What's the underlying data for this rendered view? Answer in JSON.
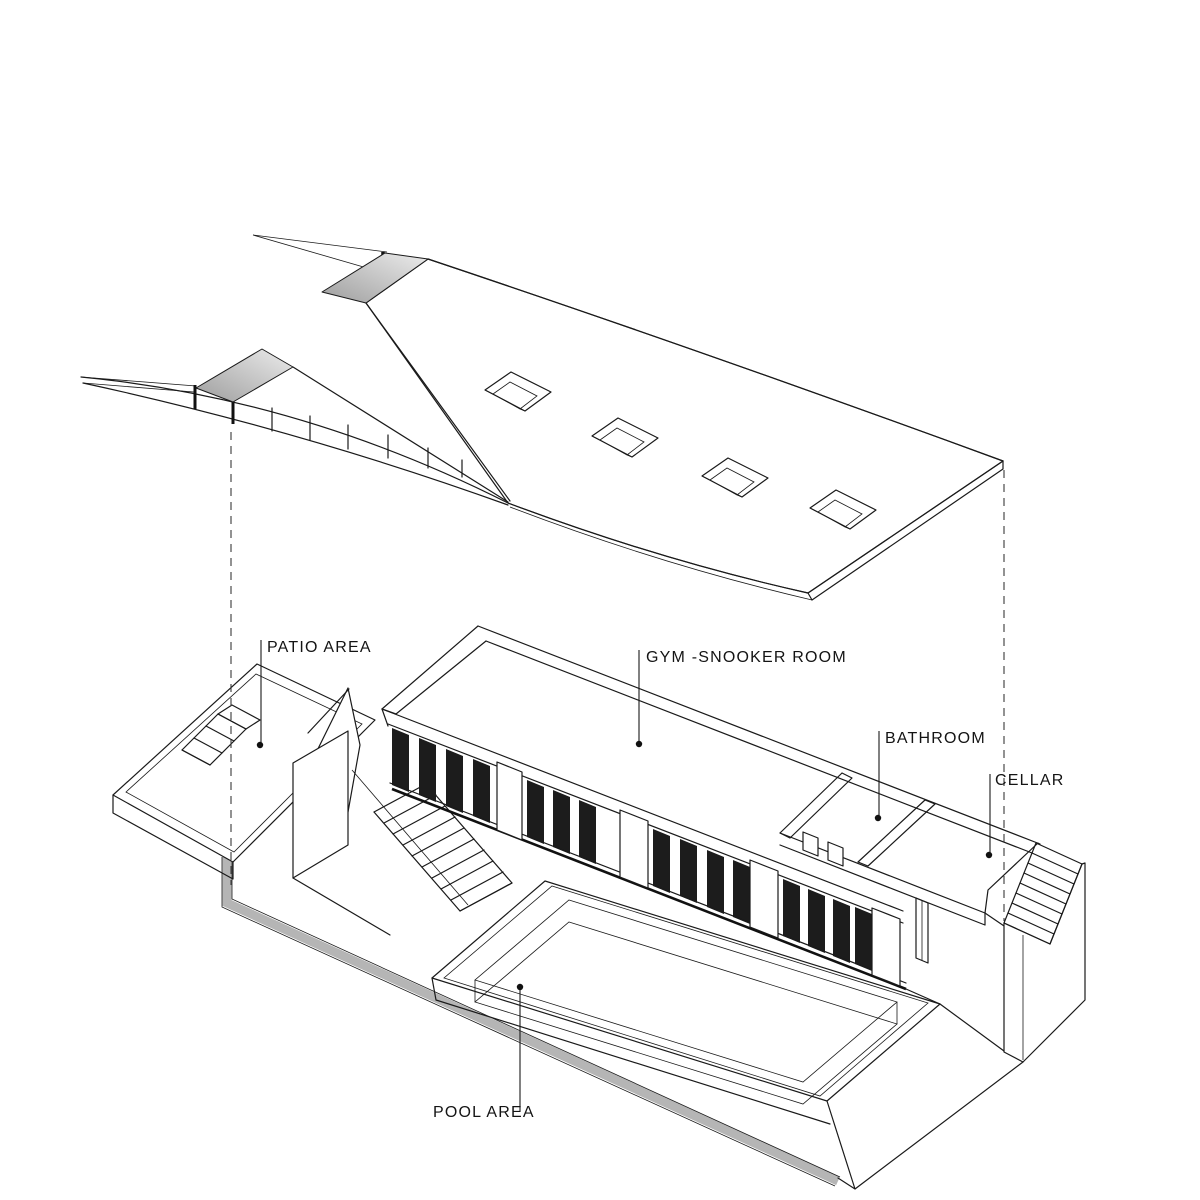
{
  "diagram": {
    "title": "exploded-axonometric-basement-plan",
    "background_color": "#ffffff",
    "line_color": "#1a1a1a",
    "shade_color": "#c9c9c9",
    "glass_color": "#1c1c1c",
    "labels": {
      "patio": "PATIO AREA",
      "gym": "GYM -SNOOKER ROOM",
      "bathroom": "BATHROOM",
      "cellar": "CELLAR",
      "pool": "POOL AREA"
    }
  }
}
